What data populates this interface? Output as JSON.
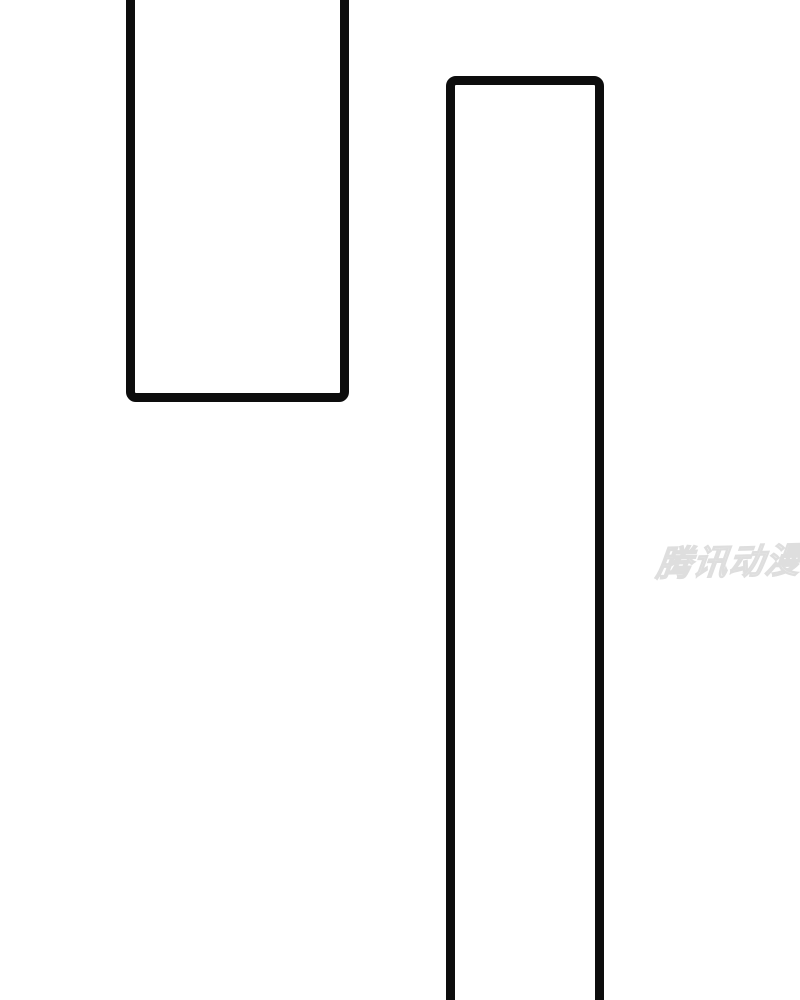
{
  "page": {
    "type": "comic-page",
    "background_color": "#ffffff",
    "panel_border_color": "#0d0d0d"
  },
  "panels": [
    {
      "name": "top-left-panel",
      "content": ""
    },
    {
      "name": "right-tall-panel",
      "content": ""
    }
  ],
  "watermark": {
    "text": "腾讯动漫",
    "fill_color": "#f4f4f4",
    "outline_color": "#dedede"
  }
}
